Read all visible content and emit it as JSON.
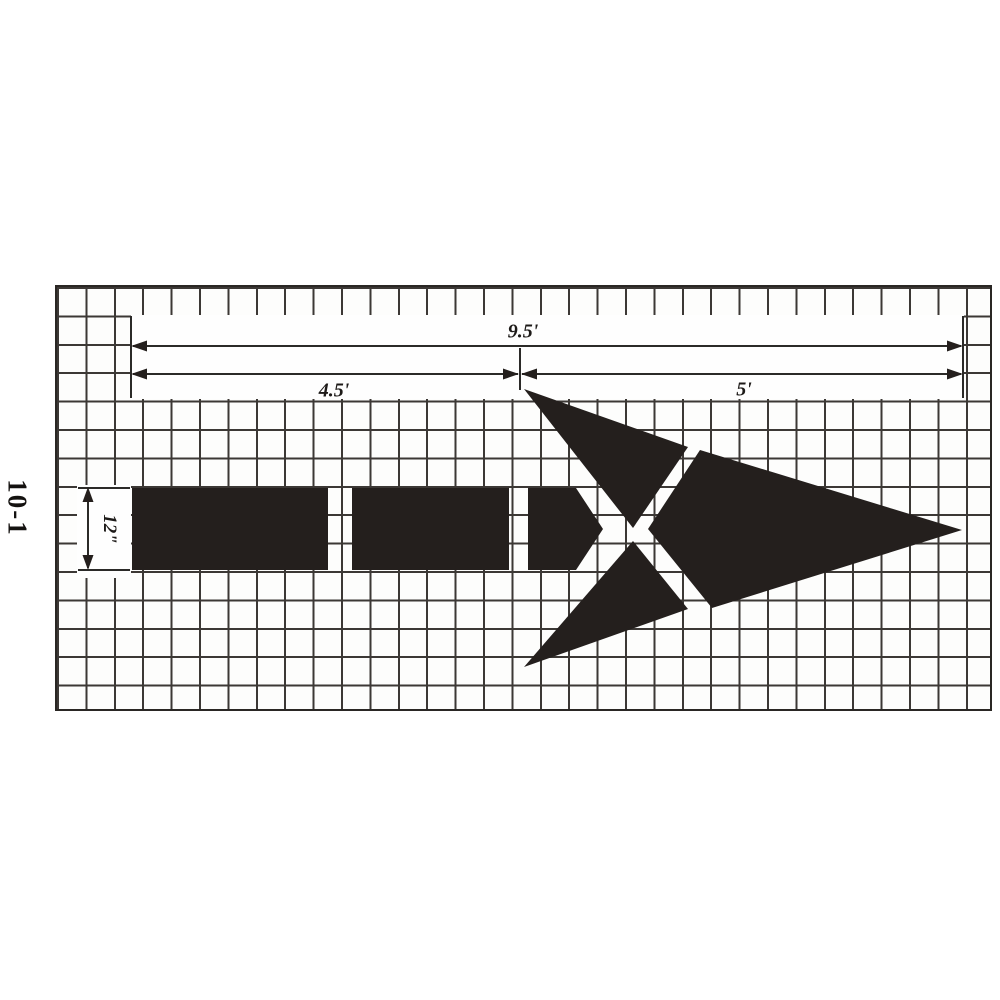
{
  "stencil": {
    "id_label": "10-1",
    "colors": {
      "ink": "#241f1d",
      "dim_line": "#2b2a28",
      "grid_line": "#3c3835",
      "background": "#ffffff"
    },
    "dimensions": {
      "overall_length": "9.5'",
      "tail_length": "4.5'",
      "head_length": "5'",
      "stroke_width": "12\""
    },
    "figure": {
      "type": "pavement-arrow-stencil",
      "pieces": [
        "tail-segment-1",
        "tail-segment-2",
        "tail-segment-3-pentagon",
        "upper-barb-triangle",
        "lower-barb-triangle",
        "arrow-head"
      ]
    }
  }
}
